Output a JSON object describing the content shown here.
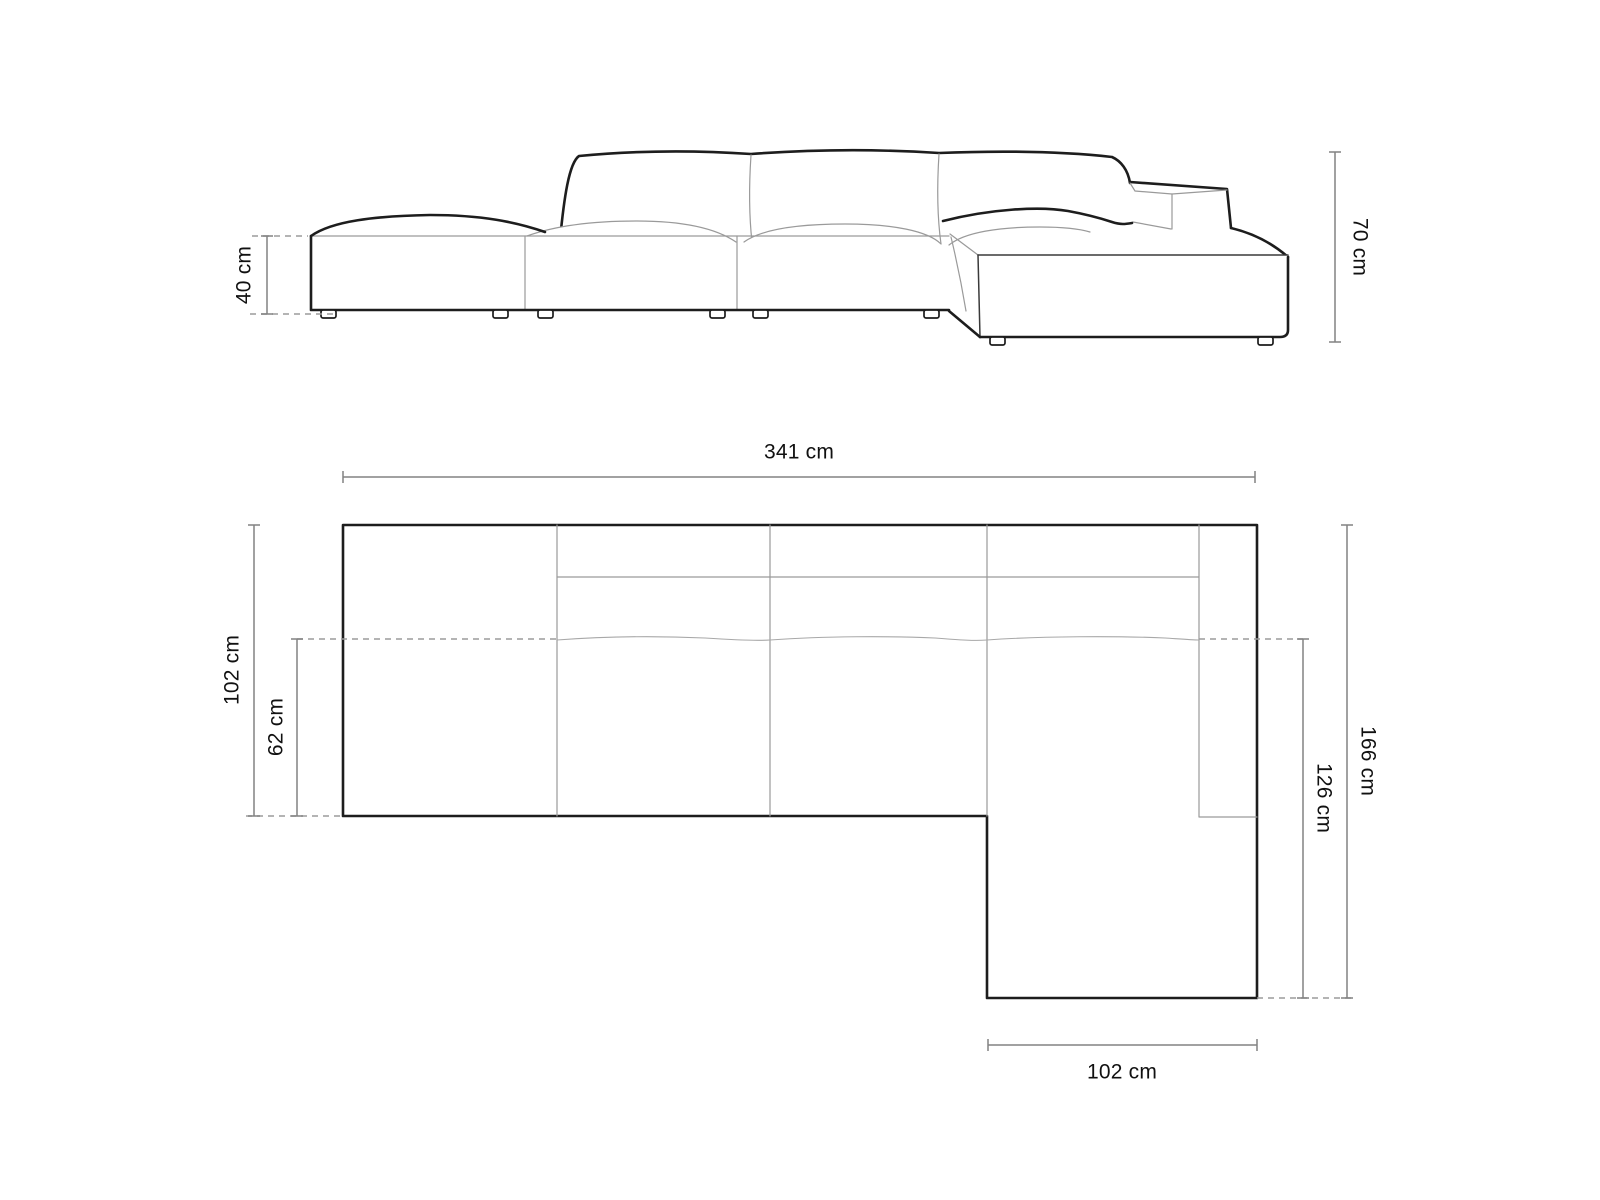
{
  "document": {
    "kind": "sofa-dimension-spec-sheet",
    "background": "#ffffff",
    "units": "cm"
  },
  "colors": {
    "sofa_outline": "#1d1d1d",
    "seam_line": "#9a9a9a",
    "dimension_line": "#828282",
    "dashed_extension": "#9b9b9b",
    "label_text": "#111111"
  },
  "views": {
    "elevation": {
      "name": "side-elevation",
      "dimensions": [
        {
          "id": "seat-height",
          "label": "40 cm",
          "value_cm": 40
        },
        {
          "id": "overall-height",
          "label": "70 cm",
          "value_cm": 70
        }
      ]
    },
    "plan": {
      "name": "top-plan",
      "dimensions": [
        {
          "id": "overall-width",
          "label": "341 cm",
          "value_cm": 341
        },
        {
          "id": "overall-depth",
          "label": "102 cm",
          "value_cm": 102
        },
        {
          "id": "seat-depth",
          "label": "62 cm",
          "value_cm": 62
        },
        {
          "id": "chaise-inner-length",
          "label": "126 cm",
          "value_cm": 126
        },
        {
          "id": "overall-length-right",
          "label": "166 cm",
          "value_cm": 166
        },
        {
          "id": "chaise-width",
          "label": "102 cm",
          "value_cm": 102
        }
      ]
    }
  }
}
